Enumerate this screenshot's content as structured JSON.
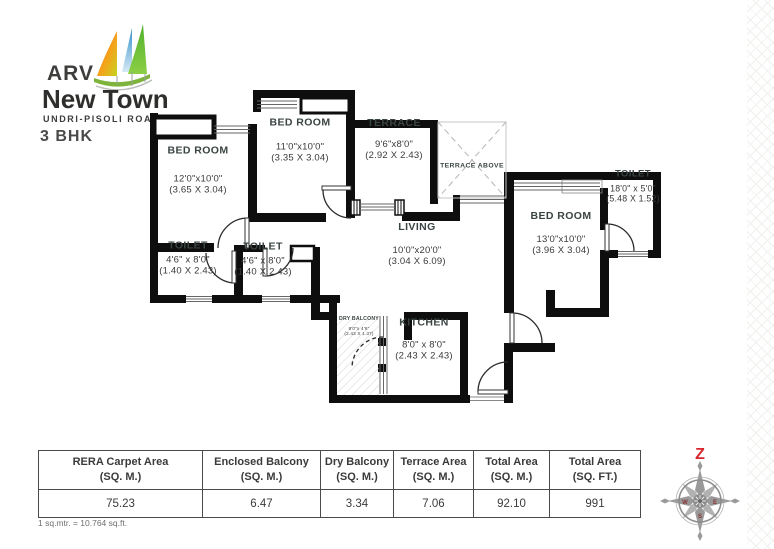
{
  "brand": {
    "name": "ARV",
    "title": "New Town",
    "subtitle": "UNDRI-PISOLI ROAD"
  },
  "plan_type": "3 BHK",
  "rooms": [
    {
      "id": "bedroom-1",
      "name": "BED ROOM",
      "dim_ft": "12'0\"x10'0\"",
      "dim_m": "(3.65 X 3.04)"
    },
    {
      "id": "bedroom-2",
      "name": "BED ROOM",
      "dim_ft": "11'0\"x10'0\"",
      "dim_m": "(3.35 X 3.04)"
    },
    {
      "id": "terrace",
      "name": "TERRACE",
      "dim_ft": "9'6\"x8'0\"",
      "dim_m": "(2.92 X 2.43)"
    },
    {
      "id": "terrace-above",
      "name": "TERRACE ABOVE",
      "dim_ft": "",
      "dim_m": ""
    },
    {
      "id": "toilet-1",
      "name": "TOILET",
      "dim_ft": "4'6\" x 8'0\"",
      "dim_m": "(1.40 X 2.43)"
    },
    {
      "id": "toilet-2",
      "name": "TOILET",
      "dim_ft": "4'6\" x 8'0\"",
      "dim_m": "(1.40 X 2.43)"
    },
    {
      "id": "living",
      "name": "LIVING",
      "dim_ft": "10'0\"x20'0\"",
      "dim_m": "(3.04 X 6.09)"
    },
    {
      "id": "bedroom-3",
      "name": "BED ROOM",
      "dim_ft": "13'0\"x10'0\"",
      "dim_m": "(3.96 X 3.04)"
    },
    {
      "id": "toilet-3",
      "name": "TOILET",
      "dim_ft": "18'0\" x 5'0\"",
      "dim_m": "(5.48 X 1.52)"
    },
    {
      "id": "kitchen",
      "name": "KITCHEN",
      "dim_ft": "8'0\" x 8'0\"",
      "dim_m": "(2.43 X 2.43)"
    },
    {
      "id": "dry-balcony",
      "name": "DRY BALCONY",
      "dim_ft": "8'0\"x 4'6\"",
      "dim_m": "(2.43 X 1.37)"
    }
  ],
  "area_table": {
    "columns": [
      {
        "label": "RERA Carpet Area",
        "unit": "(SQ. M.)",
        "value": "75.23"
      },
      {
        "label": "Enclosed Balcony",
        "unit": "(SQ. M.)",
        "value": "6.47"
      },
      {
        "label": "Dry Balcony",
        "unit": "(SQ. M.)",
        "value": "3.34"
      },
      {
        "label": "Terrace Area",
        "unit": "(SQ. M.)",
        "value": "7.06"
      },
      {
        "label": "Total Area",
        "unit": "(SQ. M.)",
        "value": "92.10"
      },
      {
        "label": "Total Area",
        "unit": "(SQ. FT.)",
        "value": "991"
      }
    ]
  },
  "footnote": "1 sq.mtr. = 10.764 sq.ft.",
  "compass": {
    "north_label": "Z",
    "west_label": "W",
    "east_label": "E",
    "south_label": "S"
  },
  "colors": {
    "wall": "#0e0e0e",
    "accent_red": "#d9252b",
    "sail_orange": "#ef7d1a",
    "sail_blue": "#57a7d9",
    "sail_green": "#57b531"
  }
}
